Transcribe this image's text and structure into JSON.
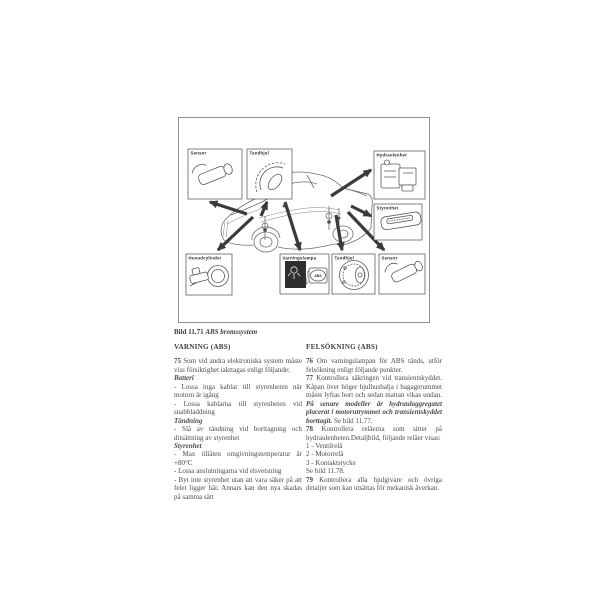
{
  "figure": {
    "caption": {
      "prefix": "Bild 11.71",
      "title": "ABS bromssystem"
    },
    "callouts": [
      {
        "id": "sensor-front",
        "label": "Sensor"
      },
      {
        "id": "tandhjul-front",
        "label": "Tandhjul"
      },
      {
        "id": "hydraulenhet",
        "label": "Hydraulenhet"
      },
      {
        "id": "styrenhet",
        "label": "Styrenhet"
      },
      {
        "id": "huvudcylinder",
        "label": "Huvudcylinder"
      },
      {
        "id": "varningslampa",
        "label": "Varningslampa"
      },
      {
        "id": "tandhjul-rear",
        "label": "Tandhjul"
      },
      {
        "id": "sensor-rear",
        "label": "Sensor"
      }
    ],
    "warning_lamp_text": "ABS"
  },
  "columns": {
    "left": {
      "header": "VARNING (ABS)",
      "blocks": [
        {
          "style": "para",
          "runs": [
            {
              "t": "75 ",
              "b": true
            },
            {
              "t": "Som vid andra elektroniska system måste viss försiktighet iakttagas enligt följande:"
            }
          ]
        },
        {
          "style": "subhead",
          "runs": [
            {
              "t": "Batteri"
            }
          ]
        },
        {
          "style": "para",
          "runs": [
            {
              "t": "- Lossa inga kablar till styrenheten när motorn är igång"
            }
          ]
        },
        {
          "style": "para",
          "runs": [
            {
              "t": "- Lossa kablarna till styrenheten vid snabbladdning"
            }
          ]
        },
        {
          "style": "subhead",
          "runs": [
            {
              "t": "Tändning"
            }
          ]
        },
        {
          "style": "para",
          "runs": [
            {
              "t": "- Slå av tändning vid borttagning och ditsättning av styrenhet"
            }
          ]
        },
        {
          "style": "subhead",
          "runs": [
            {
              "t": "Styrenhet"
            }
          ]
        },
        {
          "style": "para",
          "runs": [
            {
              "t": "- Max tillåten omgivningstemperatur är +80°C"
            }
          ]
        },
        {
          "style": "para",
          "runs": [
            {
              "t": "- Lossa anslutningarna vid elsvetsning"
            }
          ]
        },
        {
          "style": "para",
          "runs": [
            {
              "t": "- Byt inte styrenhet utan att vara säker på att felet ligger här. Annars kan den nya skadas på samma sätt"
            }
          ]
        }
      ]
    },
    "right": {
      "header": "FELSÖKNING (ABS)",
      "blocks": [
        {
          "style": "para",
          "runs": [
            {
              "t": "76 ",
              "b": true
            },
            {
              "t": "Om varningslampan för ABS tänds, utför felsökning enligt följande punkter."
            }
          ]
        },
        {
          "style": "para",
          "runs": [
            {
              "t": "77 ",
              "b": true
            },
            {
              "t": "Kontrollera säkringen vid transientskyddet. Kåpan över höger hjulhusbalja i bagagerummet måste lyftas bort och sedan mattan vikas undan. "
            },
            {
              "t": "På senare modeller är hydraulaggregatet placerat i motorutrymmet och transientskyddet borttagit.",
              "bi": true
            },
            {
              "t": " Se bild 11.77."
            }
          ]
        },
        {
          "style": "para",
          "runs": [
            {
              "t": "78 ",
              "b": true
            },
            {
              "t": "Kontrollera reläerna som sitter på hydraulenheten.Detaljbild, följande reläer visas:"
            }
          ]
        },
        {
          "style": "line",
          "runs": [
            {
              "t": "1 - Ventilrelä"
            }
          ]
        },
        {
          "style": "line",
          "runs": [
            {
              "t": "2 - Motorrelä"
            }
          ]
        },
        {
          "style": "line",
          "runs": [
            {
              "t": "3 - Kontaktstycke"
            }
          ]
        },
        {
          "style": "line",
          "runs": [
            {
              "t": "Se bild 11.78."
            }
          ]
        },
        {
          "style": "para",
          "runs": [
            {
              "t": "79 ",
              "b": true
            },
            {
              "t": "Kontrollera alla hjulgivare och övriga detaljer som kan utsättas för mekanisk åverkan."
            }
          ]
        }
      ]
    }
  },
  "colors": {
    "text": "#4a4a52",
    "frame_border": "#8f8f8f",
    "diagram_line": "#6e6e6e",
    "arrow": "#3a3a3a",
    "lamp_dark": "#2e2e30"
  }
}
